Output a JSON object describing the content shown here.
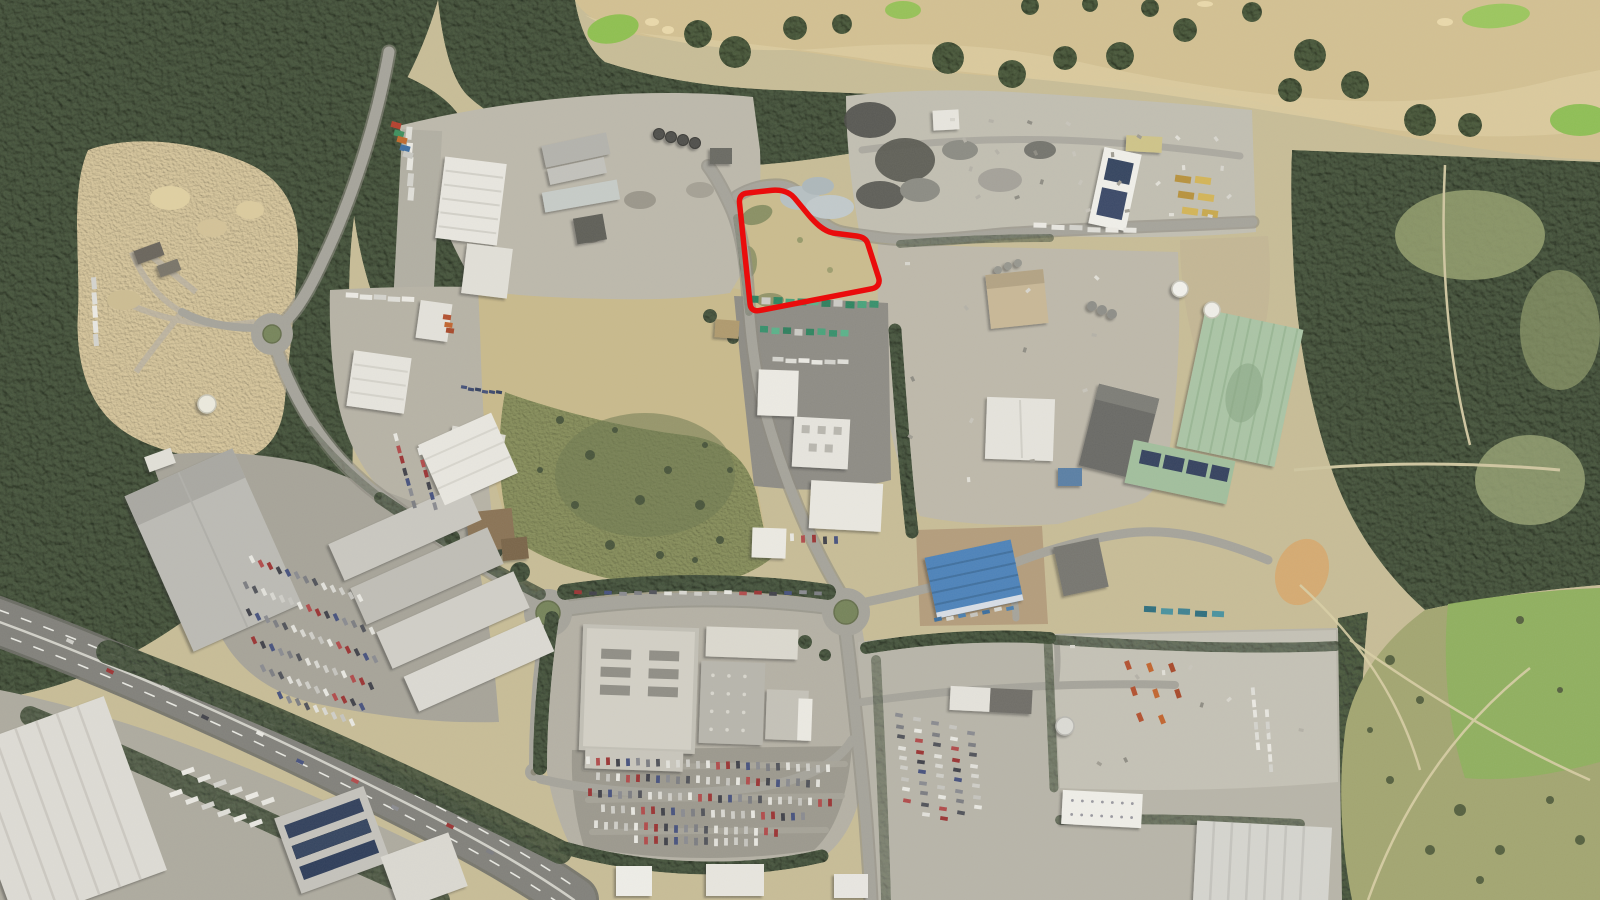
{
  "map": {
    "type": "satellite-aerial-photo",
    "annotation": {
      "site_boundary": {
        "shape": "polygon",
        "description": "red outlined development site on scrub land beside industrial estate road",
        "color": "#ea0c0c",
        "stroke_width": 5.5,
        "path": "M 739.5,203 C 739,197.5 741.5,194 746,193.2 L 770,190.5 C 779,189.3 788.5,191 794.5,198 L 809,215.5 C 815,222.5 823,230.8 833,233 L 856.5,236 C 862,236.7 866,238.5 867.6,243.2 L 878.6,277.6 C 880.3,283.2 877.6,287.6 872,288.7 L 759,310.6 C 754,311.5 750.6,309 750.1,304.2 Z",
        "interior_fill": "#cbbc8e"
      }
    },
    "palette": {
      "woodland": "#46543c",
      "golf_fairway": "#d3c192",
      "golf_green": "#8fc050",
      "quarry_sand": "#d8c79d",
      "scrub_field_dry": "#c9ba8c",
      "scrub_field_green": "#828c58",
      "heath": "#a3a671",
      "green_field": "#8fb05e",
      "industrial_concrete": "#bdb9ac",
      "asphalt_yard": "#8e8c85",
      "road": "#a6a49b",
      "highway": "#82817b",
      "warehouse_white": "#e9e7e0",
      "warehouse_green_roof": "#abc5a6",
      "building_blue_roof": "#4e83ba",
      "retail_roof": "#d3d0c6"
    },
    "features": [
      "woodland-west",
      "woodland-top",
      "woodland-east",
      "sand-quarry-works",
      "golf-course",
      "central-scrub-field",
      "site-boundary-red-outline",
      "industrial-estate-north",
      "scrap-yard-north-east",
      "container-plant-yard",
      "industrial-estate-centre-east",
      "green-roof-warehouse",
      "blue-roof-building",
      "big-warehouse-west",
      "retail-store",
      "retail-car-park",
      "dual-carriageway-highway",
      "roundabout-west",
      "roundabout-centre",
      "roundabout-east",
      "mini-roundabout",
      "heathland-south-east",
      "green-paddock-east"
    ]
  }
}
